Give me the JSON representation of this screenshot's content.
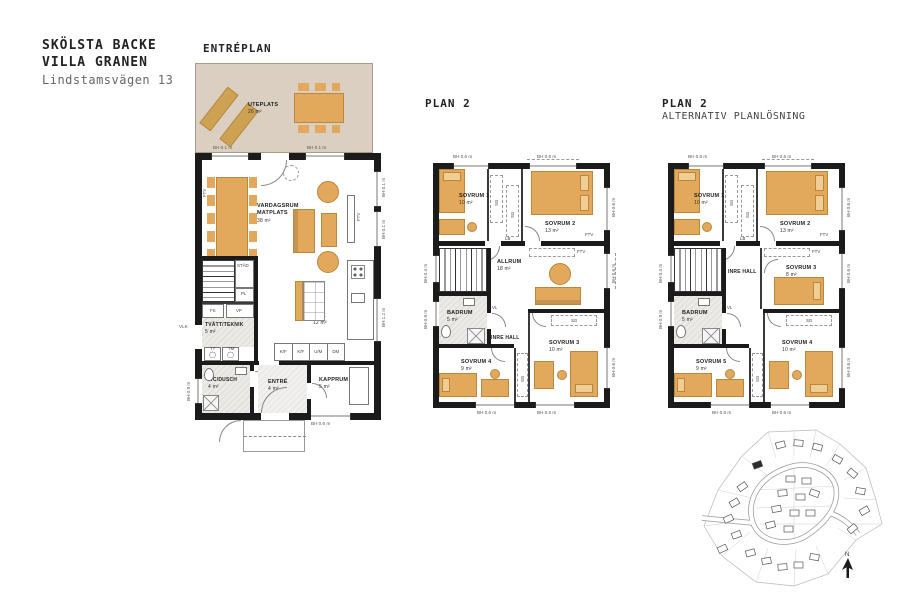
{
  "project": {
    "line1": "SKÖLSTA BACKE",
    "line2": "VILLA GRANEN",
    "line3": "Lindstamsvägen 13"
  },
  "labels": {
    "sg": "SG",
    "lb": "LB",
    "vl": "VL",
    "ftv": "FTV",
    "vlk": "VLK",
    "fs": "FS",
    "vp": "VP",
    "pl": "PL",
    "tt": "TT",
    "tm": "TM",
    "kf": "K/F",
    "um": "U/M",
    "dm": "DM",
    "stad": "STÄD",
    "inre_hall": "INRE HALL",
    "north": "N"
  },
  "dims": {
    "bh01": "BH 0.1 m",
    "bh04": "BH 0.4 m",
    "bh06": "BH 0.6 m",
    "bh09": "BH 0.9 m",
    "bh12": "BH 1.2 m"
  },
  "entreplan": {
    "title": "ENTRÉPLAN",
    "uteplats_name": "UTEPLATS",
    "uteplats_area": "26 m²",
    "vardagsrum_name1": "VARDAGSRUM",
    "vardagsrum_name2": "MATPLATS",
    "vardagsrum_area": "38 m²",
    "tvatt_name": "TVÄTT/TEKNIK",
    "tvatt_area": "5 m²",
    "wc_name": "WC/DUSCH",
    "wc_area": "4 m²",
    "entre_name": "ENTRÉ",
    "entre_area": "4 m²",
    "kapprum_name": "KAPPRUM",
    "kapprum_area": "5 m²",
    "kok_name": "KÖK",
    "kok_area": "12 m²"
  },
  "plan2": {
    "title": "PLAN 2",
    "sovrum1_name": "SOVRUM 1",
    "sovrum1_area": "10 m²",
    "sovrum2_name": "SOVRUM 2",
    "sovrum2_area": "13 m²",
    "allrum_name": "ALLRUM",
    "allrum_area": "18 m²",
    "badrum_name": "BADRUM",
    "badrum_area": "5 m²",
    "sovrum3_name": "SOVRUM 3",
    "sovrum3_area": "10 m²",
    "sovrum4_name": "SOVRUM 4",
    "sovrum4_area": "9 m²"
  },
  "plan2alt": {
    "title": "PLAN 2",
    "subtitle": "ALTERNATIV PLANLÖSNING",
    "sovrum1_name": "SOVRUM 1",
    "sovrum1_area": "10 m²",
    "sovrum2_name": "SOVRUM 2",
    "sovrum2_area": "13 m²",
    "sovrum3_name": "SOVRUM 3",
    "sovrum3_area": "8 m²",
    "badrum_name": "BADRUM",
    "badrum_area": "5 m²",
    "sovrum5_name": "SOVRUM 5",
    "sovrum5_area": "9 m²",
    "sovrum4_name": "SOVRUM 4",
    "sovrum4_area": "10 m²"
  },
  "colors": {
    "furniture": "#e2a95c",
    "terrace": "#dbcfc1",
    "wall": "#1b1b1b"
  }
}
